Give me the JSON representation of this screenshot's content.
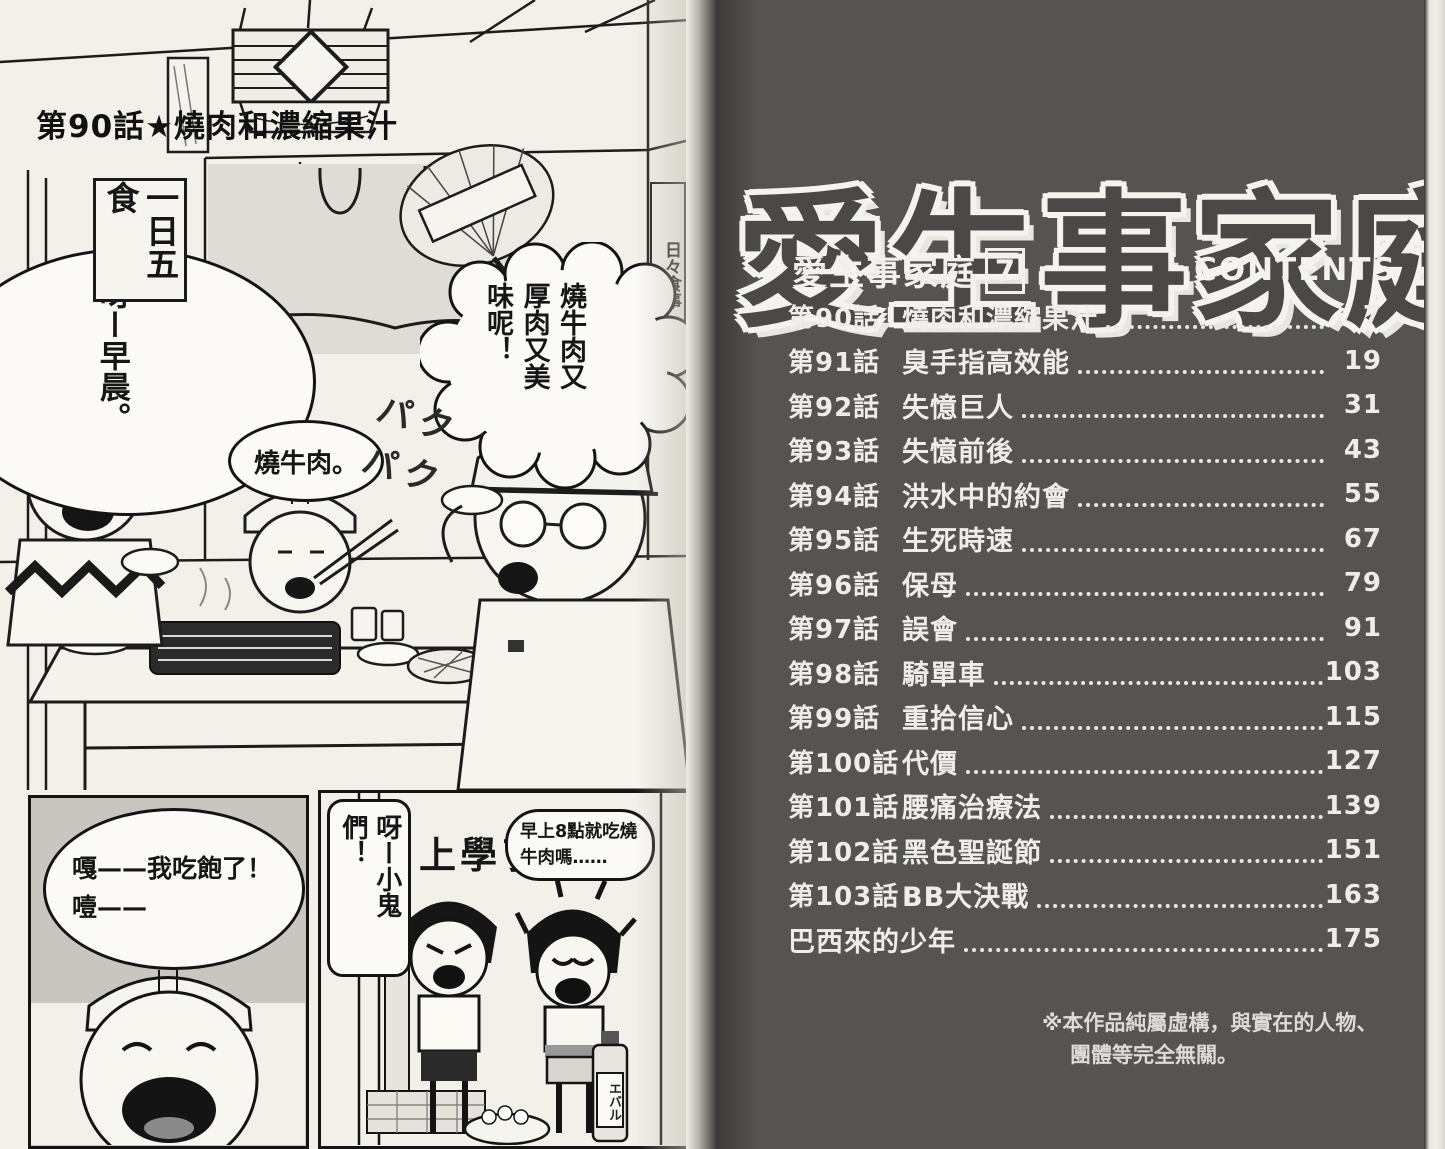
{
  "left_page": {
    "chapter_title": "第90話★燒肉和濃縮果汁",
    "wall_plaque": "一日五食",
    "poster": "日々食事",
    "sfx_munching": "パクパク",
    "bottle_label": "エバル",
    "bubbles": {
      "morning_greeting": "呀ー早晨。",
      "yakiniku": "燒牛肉。",
      "tasty": "燒牛肉又厚肉又美味呢！",
      "full": "嘎——我吃飽了！噎——",
      "hey_kids": "呀ー小鬼們！",
      "school": "上學了！",
      "morning_8": "早上8點就吃燒牛肉嗎……"
    }
  },
  "right_page": {
    "big_title": "愛生事家庭",
    "series_label": "愛生事家庭",
    "volume_number": "7",
    "contents_label": "CONTENTS",
    "toc": [
      {
        "chapter": "第90話",
        "title": "燒肉和濃縮果汁",
        "page": "7"
      },
      {
        "chapter": "第91話",
        "title": "臭手指高效能",
        "page": "19"
      },
      {
        "chapter": "第92話",
        "title": "失憶巨人",
        "page": "31"
      },
      {
        "chapter": "第93話",
        "title": "失憶前後",
        "page": "43"
      },
      {
        "chapter": "第94話",
        "title": "洪水中的約會",
        "page": "55"
      },
      {
        "chapter": "第95話",
        "title": "生死時速",
        "page": "67"
      },
      {
        "chapter": "第96話",
        "title": "保母",
        "page": "79"
      },
      {
        "chapter": "第97話",
        "title": "誤會",
        "page": "91"
      },
      {
        "chapter": "第98話",
        "title": "騎單車",
        "page": "103"
      },
      {
        "chapter": "第99話",
        "title": "重拾信心",
        "page": "115"
      },
      {
        "chapter": "第100話",
        "title": "代價",
        "page": "127"
      },
      {
        "chapter": "第101話",
        "title": "腰痛治療法",
        "page": "139"
      },
      {
        "chapter": "第102話",
        "title": "黑色聖誕節",
        "page": "151"
      },
      {
        "chapter": "第103話",
        "title": "BB大決戰",
        "page": "163"
      },
      {
        "chapter": "",
        "title": "巴西來的少年",
        "page": "175"
      }
    ],
    "disclaimer": [
      "※本作品純屬虛構，與實在的人物、",
      "團體等完全無關。"
    ]
  },
  "colors": {
    "right_page_bg": "#565452",
    "toc_text": "#efede9",
    "title_fill": "#4b4947",
    "title_outline": "#f5f3ee",
    "left_page_bg": "#f2f0e9",
    "ink": "#141414"
  }
}
